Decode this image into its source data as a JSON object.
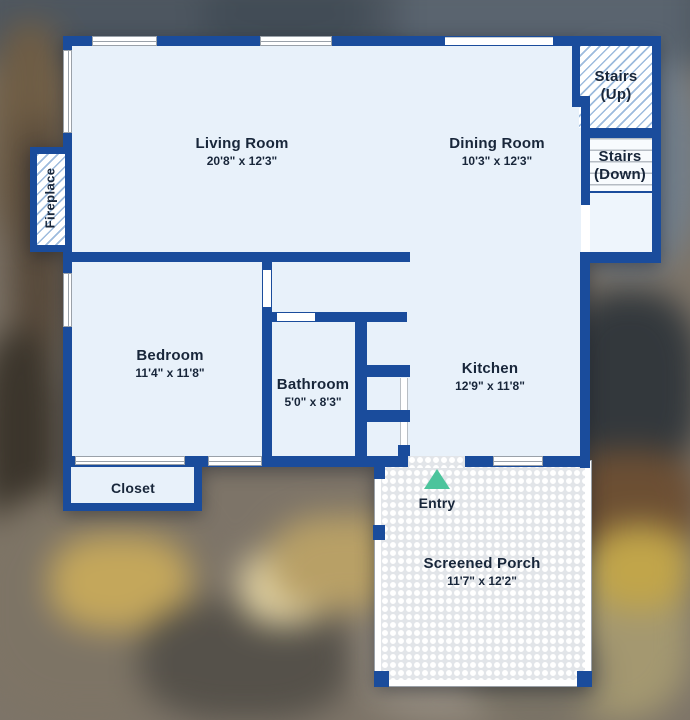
{
  "rooms": {
    "living": {
      "name": "Living Room",
      "dims": "20'8\" x 12'3\""
    },
    "dining": {
      "name": "Dining Room",
      "dims": "10'3\" x 12'3\""
    },
    "bedroom": {
      "name": "Bedroom",
      "dims": "11'4\" x 11'8\""
    },
    "bathroom": {
      "name": "Bathroom",
      "dims": "5'0\" x 8'3\""
    },
    "kitchen": {
      "name": "Kitchen",
      "dims": "12'9\" x 11'8\""
    },
    "porch": {
      "name": "Screened Porch",
      "dims": "11'7\" x 12'2\""
    }
  },
  "features": {
    "stairs_up": {
      "line1": "Stairs",
      "line2": "(Up)"
    },
    "stairs_down": {
      "line1": "Stairs",
      "line2": "(Down)"
    },
    "fireplace": "Fireplace",
    "closet": "Closet",
    "entry": "Entry"
  },
  "colors": {
    "wall": "#1a4c9c",
    "floor": "#e8f1fa",
    "hatch_line": "#9dbbdd",
    "label_text": "#18263a",
    "entry_marker": "#4cc49c"
  }
}
